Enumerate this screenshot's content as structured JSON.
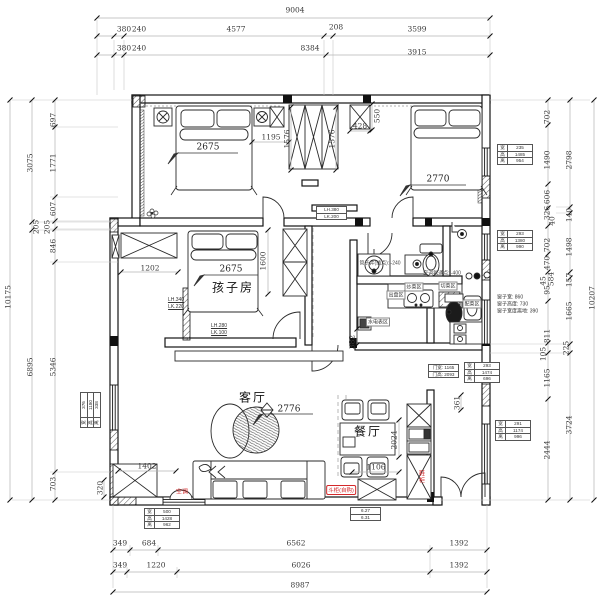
{
  "drawing": {
    "type": "residential-floor-plan"
  },
  "colors": {
    "red": "#d4282a",
    "line": "#1a1a1a",
    "dim": "#3a3a3a"
  },
  "labels": [
    {
      "t": "9004",
      "x": 295,
      "y": 10,
      "n": "dim-top-total"
    },
    {
      "t": "380",
      "x": 124,
      "y": 29
    },
    {
      "t": "240",
      "x": 139,
      "y": 29
    },
    {
      "t": "4577",
      "x": 236,
      "y": 29
    },
    {
      "t": "208",
      "x": 336,
      "y": 27
    },
    {
      "t": "3599",
      "x": 417,
      "y": 29
    },
    {
      "t": "380",
      "x": 124,
      "y": 48
    },
    {
      "t": "240",
      "x": 139,
      "y": 48
    },
    {
      "t": "8384",
      "x": 310,
      "y": 48
    },
    {
      "t": "3915",
      "x": 417,
      "y": 52
    },
    {
      "t": "349",
      "x": 120,
      "y": 543
    },
    {
      "t": "684",
      "x": 149,
      "y": 543
    },
    {
      "t": "6562",
      "x": 296,
      "y": 543
    },
    {
      "t": "1392",
      "x": 459,
      "y": 543
    },
    {
      "t": "349",
      "x": 120,
      "y": 565
    },
    {
      "t": "1220",
      "x": 156,
      "y": 565
    },
    {
      "t": "6026",
      "x": 301,
      "y": 565
    },
    {
      "t": "1392",
      "x": 459,
      "y": 565
    },
    {
      "t": "8987",
      "x": 300,
      "y": 585,
      "n": "dim-bottom-total"
    },
    {
      "t": "10175",
      "x": 8,
      "y": 297,
      "c": "v",
      "n": "dim-left-total"
    },
    {
      "t": "3075",
      "x": 30,
      "y": 163,
      "c": "v"
    },
    {
      "t": "205",
      "x": 36,
      "y": 227,
      "c": "v"
    },
    {
      "t": "6895",
      "x": 30,
      "y": 367,
      "c": "v"
    },
    {
      "t": "697",
      "x": 53,
      "y": 120,
      "c": "v"
    },
    {
      "t": "1771",
      "x": 53,
      "y": 163,
      "c": "v"
    },
    {
      "t": "607",
      "x": 53,
      "y": 209,
      "c": "v"
    },
    {
      "t": "205",
      "x": 47,
      "y": 227,
      "c": "v"
    },
    {
      "t": "846",
      "x": 53,
      "y": 246,
      "c": "v"
    },
    {
      "t": "5346",
      "x": 53,
      "y": 367,
      "c": "v"
    },
    {
      "t": "703",
      "x": 53,
      "y": 484,
      "c": "v"
    },
    {
      "t": "320",
      "x": 100,
      "y": 488,
      "c": "v"
    },
    {
      "t": "10207",
      "x": 592,
      "y": 298,
      "c": "v",
      "n": "dim-right-total"
    },
    {
      "t": "2798",
      "x": 569,
      "y": 160,
      "c": "v"
    },
    {
      "t": "140",
      "x": 569,
      "y": 215,
      "c": "v"
    },
    {
      "t": "1498",
      "x": 569,
      "y": 247,
      "c": "v"
    },
    {
      "t": "157",
      "x": 569,
      "y": 280,
      "c": "v"
    },
    {
      "t": "1665",
      "x": 569,
      "y": 311,
      "c": "v"
    },
    {
      "t": "225",
      "x": 566,
      "y": 348,
      "c": "v"
    },
    {
      "t": "3724",
      "x": 569,
      "y": 425,
      "c": "v"
    },
    {
      "t": "702",
      "x": 547,
      "y": 117,
      "c": "v"
    },
    {
      "t": "1490",
      "x": 547,
      "y": 160,
      "c": "v"
    },
    {
      "t": "606",
      "x": 547,
      "y": 197,
      "c": "v"
    },
    {
      "t": "326",
      "x": 547,
      "y": 213,
      "c": "v"
    },
    {
      "t": "40",
      "x": 552,
      "y": 221,
      "c": "v"
    },
    {
      "t": "702",
      "x": 547,
      "y": 245,
      "c": "v"
    },
    {
      "t": "470",
      "x": 547,
      "y": 263,
      "c": "v"
    },
    {
      "t": "584",
      "x": 551,
      "y": 279,
      "c": "v"
    },
    {
      "t": "45",
      "x": 543,
      "y": 281,
      "c": "v"
    },
    {
      "t": "95",
      "x": 547,
      "y": 290,
      "c": "v"
    },
    {
      "t": "811",
      "x": 547,
      "y": 336,
      "c": "v"
    },
    {
      "t": "105",
      "x": 543,
      "y": 354,
      "c": "v"
    },
    {
      "t": "1165",
      "x": 547,
      "y": 378,
      "c": "v"
    },
    {
      "t": "2444",
      "x": 547,
      "y": 450,
      "c": "v"
    },
    {
      "t": "2675",
      "x": 208,
      "y": 148,
      "c": "ul",
      "n": "dim-bed-master"
    },
    {
      "t": "1195",
      "x": 271,
      "y": 137
    },
    {
      "t": "1576",
      "x": 287,
      "y": 139,
      "c": "v"
    },
    {
      "t": "1576",
      "x": 332,
      "y": 139,
      "c": "v"
    },
    {
      "t": "428",
      "x": 360,
      "y": 126
    },
    {
      "t": "550",
      "x": 377,
      "y": 116,
      "c": "v"
    },
    {
      "t": "2770",
      "x": 438,
      "y": 180,
      "c": "ul",
      "n": "dim-bed-second"
    },
    {
      "t": "2675",
      "x": 231,
      "y": 270,
      "c": "ul",
      "n": "dim-bed-children"
    },
    {
      "t": "孩子房",
      "x": 233,
      "y": 287,
      "c": "room",
      "n": "room-label-children"
    },
    {
      "t": "1600",
      "x": 263,
      "y": 261,
      "c": "v"
    },
    {
      "t": "1202",
      "x": 150,
      "y": 268
    },
    {
      "t": "客厅",
      "x": 253,
      "y": 397,
      "c": "room",
      "n": "room-label-living"
    },
    {
      "t": "2776",
      "x": 289,
      "y": 410,
      "c": "ul",
      "n": "dim-living"
    },
    {
      "t": "餐厅",
      "x": 368,
      "y": 431,
      "c": "room",
      "n": "room-label-dining"
    },
    {
      "t": "2024",
      "x": 394,
      "y": 440,
      "c": "v"
    },
    {
      "t": "1106",
      "x": 376,
      "y": 467
    },
    {
      "t": "1402",
      "x": 147,
      "y": 466
    },
    {
      "t": "382",
      "x": 352,
      "y": 342,
      "c": "v"
    },
    {
      "t": "361",
      "x": 457,
      "y": 403,
      "c": "v"
    },
    {
      "t": "空调",
      "x": 182,
      "y": 491,
      "c": "r",
      "n": "ac-note"
    },
    {
      "t": "斗柜(自购)",
      "x": 341,
      "y": 490,
      "c": "rb",
      "n": "cabinet-note"
    },
    {
      "t": "鞋柜",
      "x": 421,
      "y": 477,
      "c": "rv",
      "n": "shoe-cabinet-note"
    },
    {
      "t": "管子井(插点): -240",
      "x": 380,
      "y": 263,
      "c": "t",
      "n": "pipe-note"
    },
    {
      "t": "空调氟通点: -400",
      "x": 442,
      "y": 273,
      "c": "t",
      "n": "ac-point-note"
    },
    {
      "t": "出盘区",
      "x": 396,
      "y": 295,
      "c": "tb",
      "n": "zone-label-plating"
    },
    {
      "t": "炒菜区",
      "x": 414,
      "y": 287,
      "c": "tb",
      "n": "zone-label-cooking"
    },
    {
      "t": "切菜区",
      "x": 448,
      "y": 286,
      "c": "tb",
      "n": "zone-label-cutting"
    },
    {
      "t": "配菜区",
      "x": 472,
      "y": 304,
      "c": "tb",
      "n": "zone-label-prep"
    },
    {
      "t": "水电表区",
      "x": 378,
      "y": 322,
      "c": "tb",
      "n": "zone-label-meters"
    },
    {
      "t": "窗子宽: 860",
      "x": 497,
      "y": 297,
      "c": "tl",
      "n": "window-note"
    },
    {
      "t": "窗子高度: 730",
      "x": 497,
      "y": 304,
      "c": "tl",
      "n": "window-note"
    },
    {
      "t": "窗子宽度离地: 390",
      "x": 497,
      "y": 311,
      "c": "tl",
      "n": "window-note"
    },
    {
      "t": "LH.340",
      "x": 176,
      "y": 300,
      "c": "tu",
      "n": "beam-note"
    },
    {
      "t": "LK.220",
      "x": 176,
      "y": 307,
      "c": "tu",
      "n": "beam-note"
    },
    {
      "t": "LH.280",
      "x": 219,
      "y": 326,
      "c": "tu",
      "n": "beam-note"
    },
    {
      "t": "LK.100",
      "x": 219,
      "y": 333,
      "c": "tu",
      "n": "beam-note"
    }
  ],
  "tables": [
    {
      "n": "window-spec-table",
      "x": 497,
      "y": 144,
      "rows": [
        [
          "宽",
          "235"
        ],
        [
          "高",
          "1485"
        ],
        [
          "离",
          "954"
        ]
      ]
    },
    {
      "n": "window-spec-table",
      "x": 497,
      "y": 230,
      "rows": [
        [
          "宽",
          "293"
        ],
        [
          "高",
          "1380"
        ],
        [
          "离",
          "990"
        ]
      ]
    },
    {
      "n": "window-spec-table",
      "x": 495,
      "y": 420,
      "rows": [
        [
          "宽",
          "291"
        ],
        [
          "高",
          "1174"
        ],
        [
          "离",
          "996"
        ]
      ]
    },
    {
      "n": "window-spec-table",
      "x": 144,
      "y": 508,
      "rows": [
        [
          "宽",
          "500"
        ],
        [
          "高",
          "1428"
        ],
        [
          "离",
          "962"
        ]
      ]
    },
    {
      "n": "window-spec-table",
      "x": 80,
      "y": 428,
      "rot": true,
      "rows": [
        [
          "宽",
          "376"
        ],
        [
          "高",
          "1180"
        ],
        [
          "离",
          "338"
        ]
      ]
    },
    {
      "n": "door-spec-table",
      "x": 428,
      "y": 364,
      "rows": [
        [
          "门宽: 1165"
        ],
        [
          "门高: 2093"
        ]
      ]
    },
    {
      "n": "window-spec-table",
      "x": 464,
      "y": 362,
      "rows": [
        [
          "宽",
          "293"
        ],
        [
          "高",
          "1474"
        ],
        [
          "离",
          "696"
        ]
      ]
    },
    {
      "n": "level-table",
      "x": 350,
      "y": 507,
      "rows": [
        [
          "6.27"
        ],
        [
          "6.31"
        ]
      ]
    },
    {
      "n": "beam-table",
      "x": 316,
      "y": 206,
      "rows": [
        [
          "LH.380"
        ],
        [
          "LK.200"
        ]
      ]
    }
  ]
}
